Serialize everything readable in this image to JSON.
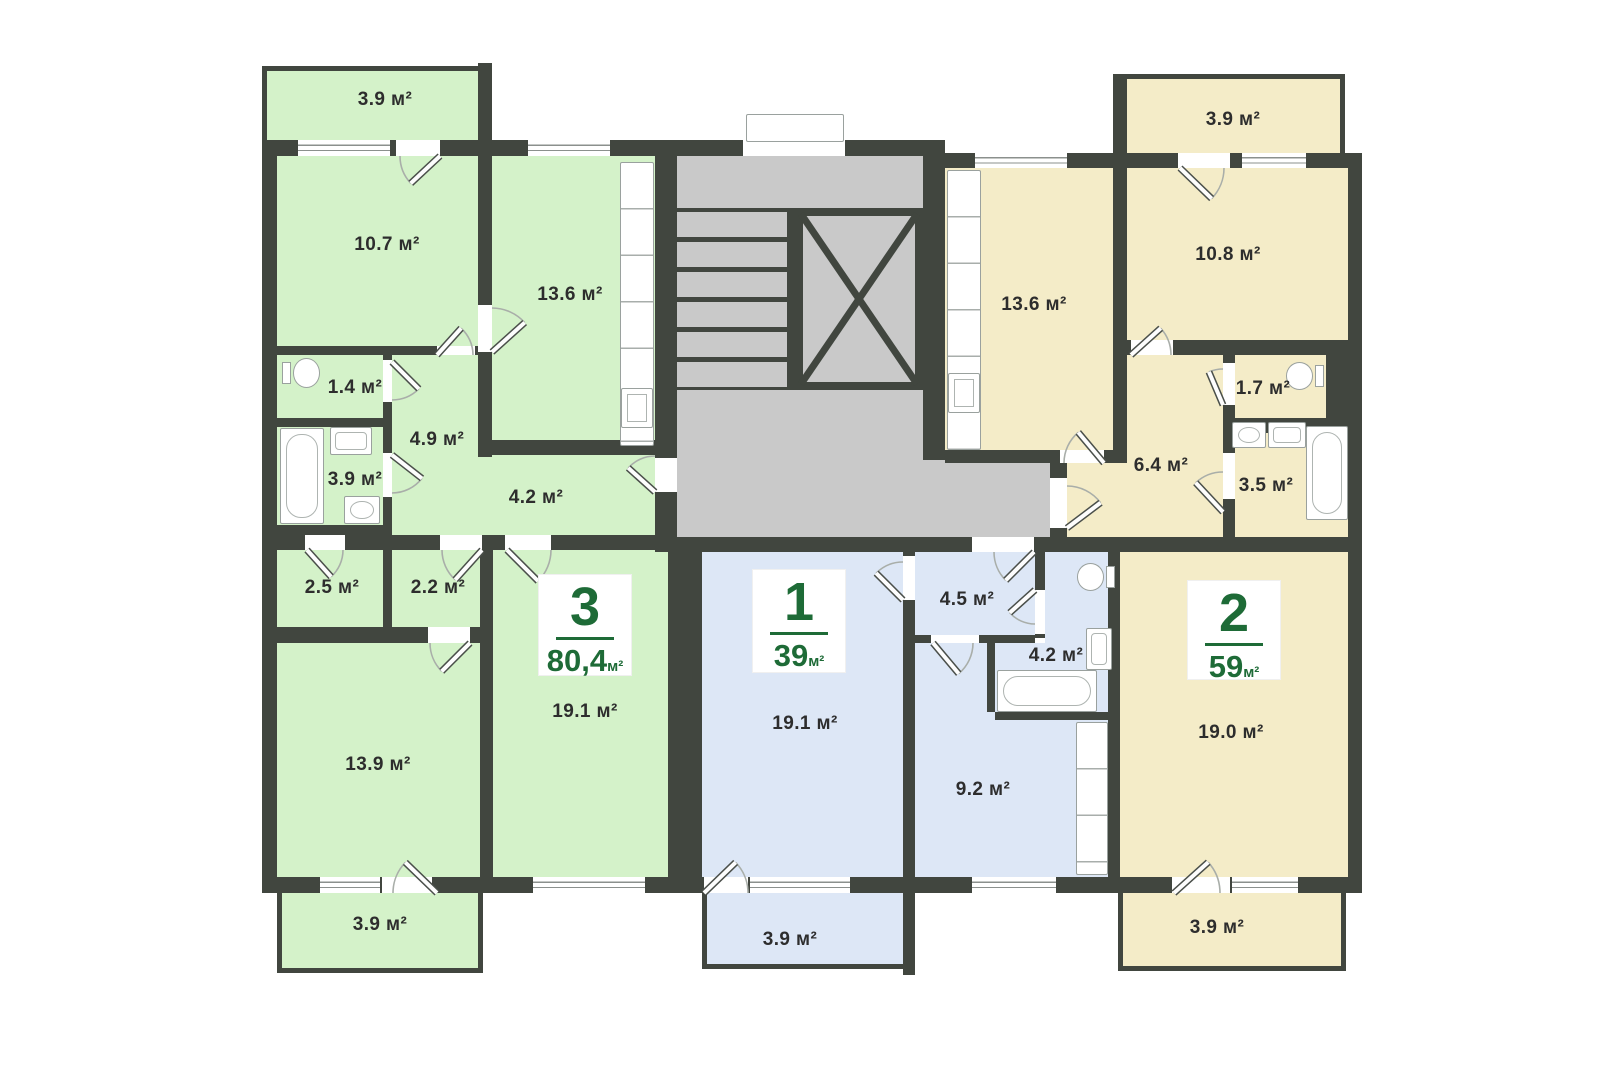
{
  "meta": {
    "kind": "apartment-floor-plan"
  },
  "unit": "м²",
  "apartments": [
    {
      "number": "3",
      "total_area": "80,4"
    },
    {
      "number": "1",
      "total_area": "39"
    },
    {
      "number": "2",
      "total_area": "59"
    }
  ],
  "plan": {
    "colors": {
      "wall": "#41463f",
      "apt3": "#d4f2c9",
      "apt1": "#dde7f6",
      "apt2": "#f4ecc8",
      "common": "#c9c9c9",
      "accent": "#1e6b37"
    },
    "regions": [
      {
        "name": "apt3-balcony-top",
        "fill": "apt3",
        "x": 262,
        "y": 66,
        "w": 216,
        "h": 74,
        "bd": "tl"
      },
      {
        "name": "apt3-room-10-7",
        "fill": "apt3",
        "x": 277,
        "y": 156,
        "w": 201,
        "h": 190
      },
      {
        "name": "apt3-kitchen",
        "fill": "apt3",
        "x": 492,
        "y": 156,
        "w": 163,
        "h": 284
      },
      {
        "name": "apt3-wc",
        "fill": "apt3",
        "x": 277,
        "y": 355,
        "w": 106,
        "h": 63
      },
      {
        "name": "apt3-bathroom",
        "fill": "apt3",
        "x": 277,
        "y": 427,
        "w": 106,
        "h": 98
      },
      {
        "name": "apt3-hall-a",
        "fill": "apt3",
        "x": 392,
        "y": 355,
        "w": 100,
        "h": 100
      },
      {
        "name": "apt3-hall-b",
        "fill": "apt3",
        "x": 392,
        "y": 455,
        "w": 263,
        "h": 80
      },
      {
        "name": "apt3-storage-2-5",
        "fill": "apt3",
        "x": 277,
        "y": 550,
        "w": 106,
        "h": 77
      },
      {
        "name": "apt3-storage-2-2",
        "fill": "apt3",
        "x": 392,
        "y": 550,
        "w": 88,
        "h": 77
      },
      {
        "name": "apt3-room-13-9",
        "fill": "apt3",
        "x": 277,
        "y": 643,
        "w": 203,
        "h": 234
      },
      {
        "name": "apt3-room-19-1",
        "fill": "apt3",
        "x": 493,
        "y": 550,
        "w": 175,
        "h": 327
      },
      {
        "name": "apt3-balcony-bottom",
        "fill": "apt3",
        "x": 277,
        "y": 893,
        "w": 206,
        "h": 80,
        "bd": "lbr"
      },
      {
        "name": "apt1-room-19-1",
        "fill": "apt1",
        "x": 702,
        "y": 552,
        "w": 201,
        "h": 325
      },
      {
        "name": "apt1-hall",
        "fill": "apt1",
        "x": 915,
        "y": 552,
        "w": 120,
        "h": 83
      },
      {
        "name": "apt1-bathroom-a",
        "fill": "apt1",
        "x": 1045,
        "y": 552,
        "w": 63,
        "h": 91
      },
      {
        "name": "apt1-bathroom-b",
        "fill": "apt1",
        "x": 995,
        "y": 643,
        "w": 113,
        "h": 69
      },
      {
        "name": "apt1-kitchen-a",
        "fill": "apt1",
        "x": 915,
        "y": 643,
        "w": 80,
        "h": 234
      },
      {
        "name": "apt1-kitchen-b",
        "fill": "apt1",
        "x": 995,
        "y": 720,
        "w": 113,
        "h": 157
      },
      {
        "name": "apt1-balcony",
        "fill": "apt1",
        "x": 702,
        "y": 893,
        "w": 201,
        "h": 76,
        "bd": "lb"
      },
      {
        "name": "apt2-balcony-top",
        "fill": "apt2",
        "x": 1127,
        "y": 74,
        "w": 218,
        "h": 79,
        "bd": "tr"
      },
      {
        "name": "apt2-kitchen",
        "fill": "apt2",
        "x": 945,
        "y": 168,
        "w": 168,
        "h": 282
      },
      {
        "name": "apt2-room-10-8",
        "fill": "apt2",
        "x": 1127,
        "y": 168,
        "w": 221,
        "h": 172
      },
      {
        "name": "apt2-hall-a",
        "fill": "apt2",
        "x": 1127,
        "y": 355,
        "w": 96,
        "h": 108
      },
      {
        "name": "apt2-hall-b",
        "fill": "apt2",
        "x": 1067,
        "y": 463,
        "w": 156,
        "h": 74
      },
      {
        "name": "apt2-wc",
        "fill": "apt2",
        "x": 1235,
        "y": 355,
        "w": 91,
        "h": 63
      },
      {
        "name": "apt2-bathroom",
        "fill": "apt2",
        "x": 1235,
        "y": 433,
        "w": 113,
        "h": 104
      },
      {
        "name": "apt2-room-19-0",
        "fill": "apt2",
        "x": 1120,
        "y": 552,
        "w": 228,
        "h": 325
      },
      {
        "name": "apt2-balcony-bottom",
        "fill": "apt2",
        "x": 1118,
        "y": 893,
        "w": 228,
        "h": 78,
        "bd": "lbr"
      }
    ],
    "common": [
      [
        677,
        156,
        246,
        381
      ],
      [
        923,
        460,
        144,
        77
      ]
    ],
    "stairs": {
      "x": 677,
      "y": 208,
      "w": 110,
      "h": 182
    },
    "elevator": {
      "x": 795,
      "y": 208,
      "w": 128,
      "h": 182
    },
    "walls": [
      [
        262,
        140,
        416,
        16
      ],
      [
        262,
        140,
        15,
        753
      ],
      [
        262,
        877,
        1100,
        16
      ],
      [
        478,
        63,
        14,
        93
      ],
      [
        478,
        156,
        14,
        301
      ],
      [
        655,
        140,
        22,
        412
      ],
      [
        677,
        140,
        246,
        16
      ],
      [
        923,
        140,
        22,
        320
      ],
      [
        945,
        153,
        417,
        15
      ],
      [
        1348,
        153,
        14,
        740
      ],
      [
        667,
        537,
        695,
        15
      ],
      [
        277,
        346,
        201,
        9
      ],
      [
        383,
        352,
        9,
        173
      ],
      [
        277,
        418,
        106,
        9
      ],
      [
        277,
        525,
        115,
        10
      ],
      [
        262,
        535,
        406,
        15
      ],
      [
        383,
        550,
        9,
        77
      ],
      [
        277,
        627,
        203,
        16
      ],
      [
        480,
        548,
        13,
        329
      ],
      [
        668,
        550,
        34,
        327
      ],
      [
        492,
        440,
        163,
        15
      ],
      [
        903,
        552,
        12,
        423
      ],
      [
        915,
        635,
        120,
        8
      ],
      [
        1035,
        552,
        10,
        86
      ],
      [
        987,
        643,
        8,
        69
      ],
      [
        995,
        712,
        113,
        8
      ],
      [
        1108,
        552,
        12,
        325
      ],
      [
        1113,
        168,
        14,
        295
      ],
      [
        945,
        450,
        168,
        13
      ],
      [
        1127,
        340,
        221,
        15
      ],
      [
        1223,
        355,
        12,
        182
      ],
      [
        1235,
        418,
        113,
        15
      ],
      [
        1326,
        355,
        22,
        63
      ],
      [
        1050,
        460,
        17,
        77
      ],
      [
        1113,
        74,
        14,
        79
      ],
      [
        787,
        208,
        8,
        182
      ]
    ],
    "windows": [
      [
        298,
        140,
        92,
        16,
        "w"
      ],
      [
        396,
        140,
        44,
        16,
        "o"
      ],
      [
        528,
        140,
        82,
        16,
        "w"
      ],
      [
        743,
        140,
        102,
        16,
        "o"
      ],
      [
        975,
        153,
        92,
        15,
        "w"
      ],
      [
        1178,
        153,
        52,
        15,
        "o"
      ],
      [
        1242,
        153,
        64,
        15,
        "w"
      ],
      [
        320,
        877,
        60,
        16,
        "w"
      ],
      [
        382,
        877,
        50,
        16,
        "o"
      ],
      [
        533,
        877,
        112,
        16,
        "w"
      ],
      [
        704,
        877,
        44,
        16,
        "o"
      ],
      [
        750,
        877,
        100,
        16,
        "w"
      ],
      [
        972,
        877,
        84,
        16,
        "w"
      ],
      [
        1172,
        877,
        58,
        16,
        "o"
      ],
      [
        1232,
        877,
        66,
        16,
        "w"
      ],
      [
        655,
        458,
        22,
        34,
        "o"
      ],
      [
        437,
        346,
        38,
        9,
        "o"
      ],
      [
        383,
        360,
        9,
        42,
        "o"
      ],
      [
        383,
        453,
        9,
        44,
        "o"
      ],
      [
        478,
        305,
        14,
        47,
        "o"
      ],
      [
        305,
        535,
        40,
        15,
        "o"
      ],
      [
        440,
        535,
        42,
        15,
        "o"
      ],
      [
        505,
        535,
        46,
        15,
        "o"
      ],
      [
        428,
        627,
        42,
        16,
        "o"
      ],
      [
        972,
        537,
        62,
        15,
        "o"
      ],
      [
        903,
        556,
        12,
        44,
        "o"
      ],
      [
        931,
        635,
        48,
        8,
        "o"
      ],
      [
        1035,
        590,
        10,
        44,
        "o"
      ],
      [
        1060,
        450,
        44,
        13,
        "o"
      ],
      [
        1131,
        340,
        42,
        15,
        "o"
      ],
      [
        1223,
        363,
        12,
        42,
        "o"
      ],
      [
        1223,
        453,
        12,
        46,
        "o"
      ],
      [
        1050,
        478,
        17,
        50,
        "o"
      ]
    ],
    "fixtures": [
      {
        "k": "toilet",
        "d": "e",
        "x": 282,
        "y": 358,
        "w": 38,
        "h": 30
      },
      {
        "k": "tub",
        "x": 280,
        "y": 428,
        "w": 44,
        "h": 96
      },
      {
        "k": "sink",
        "x": 330,
        "y": 427,
        "w": 42,
        "h": 28
      },
      {
        "k": "washer",
        "x": 344,
        "y": 496,
        "w": 36,
        "h": 28
      },
      {
        "k": "counter",
        "x": 620,
        "y": 162,
        "w": 34,
        "h": 284
      },
      {
        "k": "boxfx",
        "x": 621,
        "y": 388,
        "w": 32,
        "h": 40
      },
      {
        "k": "counter",
        "x": 947,
        "y": 170,
        "w": 34,
        "h": 280
      },
      {
        "k": "boxfx",
        "x": 948,
        "y": 373,
        "w": 32,
        "h": 40
      },
      {
        "k": "toilet",
        "d": "w",
        "x": 1077,
        "y": 563,
        "w": 38,
        "h": 28
      },
      {
        "k": "sink",
        "x": 1086,
        "y": 628,
        "w": 26,
        "h": 42
      },
      {
        "k": "tub",
        "x": 997,
        "y": 670,
        "w": 100,
        "h": 42
      },
      {
        "k": "counter",
        "x": 1076,
        "y": 722,
        "w": 32,
        "h": 153
      },
      {
        "k": "toilet",
        "d": "w",
        "x": 1286,
        "y": 362,
        "w": 38,
        "h": 28
      },
      {
        "k": "washer",
        "x": 1232,
        "y": 422,
        "w": 34,
        "h": 26
      },
      {
        "k": "sink",
        "x": 1268,
        "y": 422,
        "w": 38,
        "h": 26
      },
      {
        "k": "tub",
        "x": 1306,
        "y": 426,
        "w": 42,
        "h": 94
      },
      {
        "k": "porch",
        "x": 746,
        "y": 114,
        "w": 98,
        "h": 28
      }
    ],
    "doors": [
      [
        440,
        156,
        40,
        180,
        137
      ],
      [
        437,
        355,
        36,
        0,
        312
      ],
      [
        392,
        362,
        38,
        90,
        45
      ],
      [
        392,
        455,
        38,
        90,
        38
      ],
      [
        492,
        352,
        44,
        270,
        318
      ],
      [
        307,
        550,
        36,
        0,
        48
      ],
      [
        482,
        550,
        40,
        180,
        132
      ],
      [
        507,
        550,
        44,
        0,
        45
      ],
      [
        470,
        643,
        40,
        180,
        135
      ],
      [
        655,
        492,
        36,
        270,
        222
      ],
      [
        1034,
        552,
        40,
        180,
        135
      ],
      [
        903,
        600,
        38,
        270,
        225
      ],
      [
        1035,
        590,
        34,
        90,
        138
      ],
      [
        933,
        643,
        40,
        0,
        50
      ],
      [
        1104,
        463,
        40,
        180,
        230
      ],
      [
        1131,
        355,
        40,
        0,
        318
      ],
      [
        1223,
        405,
        36,
        270,
        247
      ],
      [
        1223,
        512,
        40,
        270,
        227
      ],
      [
        1067,
        528,
        42,
        270,
        323
      ],
      [
        437,
        893,
        44,
        180,
        224
      ],
      [
        704,
        893,
        44,
        0,
        316
      ],
      [
        1174,
        893,
        46,
        0,
        318
      ],
      [
        1180,
        168,
        44,
        0,
        44
      ]
    ],
    "badges": [
      {
        "apt": 0,
        "x": 539,
        "y": 575,
        "w": 92,
        "h": 100
      },
      {
        "apt": 1,
        "x": 753,
        "y": 570,
        "w": 92,
        "h": 102
      },
      {
        "apt": 2,
        "x": 1188,
        "y": 581,
        "w": 92,
        "h": 98
      }
    ],
    "labels": [
      {
        "t": "3.9 м²",
        "x": 385,
        "y": 100
      },
      {
        "t": "10.7 м²",
        "x": 387,
        "y": 245
      },
      {
        "t": "13.6 м²",
        "x": 570,
        "y": 295
      },
      {
        "t": "1.4 м²",
        "x": 355,
        "y": 388
      },
      {
        "t": "4.9 м²",
        "x": 437,
        "y": 440
      },
      {
        "t": "3.9 м²",
        "x": 355,
        "y": 480
      },
      {
        "t": "4.2 м²",
        "x": 536,
        "y": 498
      },
      {
        "t": "2.5 м²",
        "x": 332,
        "y": 588
      },
      {
        "t": "2.2 м²",
        "x": 438,
        "y": 588
      },
      {
        "t": "13.9 м²",
        "x": 378,
        "y": 765
      },
      {
        "t": "19.1 м²",
        "x": 585,
        "y": 712
      },
      {
        "t": "3.9 м²",
        "x": 380,
        "y": 925
      },
      {
        "t": "19.1 м²",
        "x": 805,
        "y": 724
      },
      {
        "t": "4.5 м²",
        "x": 967,
        "y": 600
      },
      {
        "t": "4.2 м²",
        "x": 1056,
        "y": 656
      },
      {
        "t": "9.2 м²",
        "x": 983,
        "y": 790
      },
      {
        "t": "3.9 м²",
        "x": 790,
        "y": 940
      },
      {
        "t": "3.9 м²",
        "x": 1233,
        "y": 120
      },
      {
        "t": "10.8 м²",
        "x": 1228,
        "y": 255
      },
      {
        "t": "13.6 м²",
        "x": 1034,
        "y": 305
      },
      {
        "t": "1.7 м²",
        "x": 1263,
        "y": 389
      },
      {
        "t": "6.4 м²",
        "x": 1161,
        "y": 466
      },
      {
        "t": "3.5 м²",
        "x": 1266,
        "y": 486
      },
      {
        "t": "19.0 м²",
        "x": 1231,
        "y": 733
      },
      {
        "t": "3.9 м²",
        "x": 1217,
        "y": 928
      }
    ]
  }
}
